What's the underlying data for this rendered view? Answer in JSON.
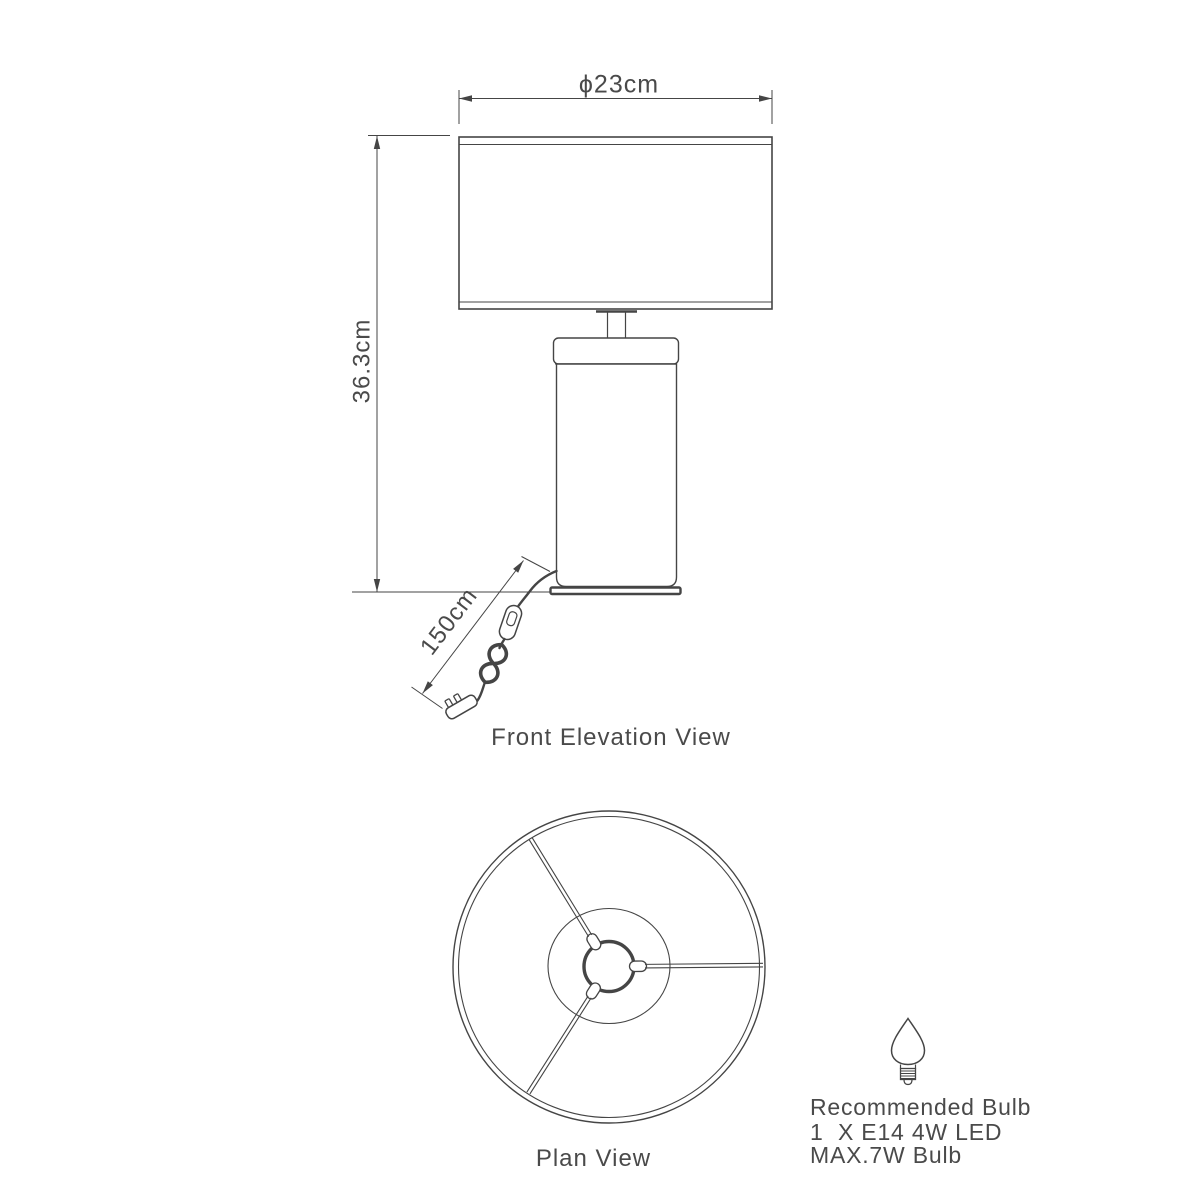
{
  "page": {
    "background_color": "#ffffff",
    "line_color": "#454545",
    "text_color": "#4a4a4a"
  },
  "front_elevation": {
    "caption": "Front Elevation View",
    "dimensions": {
      "shade_diameter": "ϕ23cm",
      "overall_height": "36.3cm",
      "cord_length": "150cm"
    }
  },
  "plan_view": {
    "caption": "Plan View"
  },
  "bulb_recommendation": {
    "icon": "candle-bulb-icon",
    "heading": "Recommended Bulb",
    "quantity_spec": "1  X E14 4W LED",
    "max_wattage": "MAX.7W Bulb"
  }
}
